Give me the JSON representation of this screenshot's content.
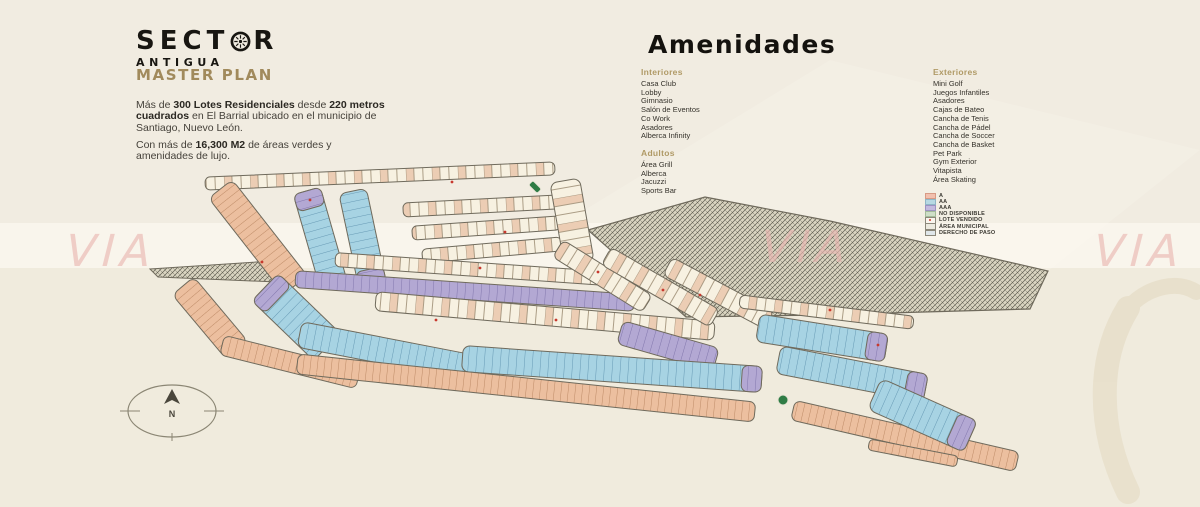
{
  "logo": {
    "word_start": "SECT",
    "word_end": "R",
    "subtitle": "ANTIGUA"
  },
  "intro": {
    "title": "MASTER PLAN",
    "p1_runs": [
      {
        "t": "Más de "
      },
      {
        "t": "300 Lotes Residenciales",
        "b": true
      },
      {
        "t": " desde "
      },
      {
        "t": "220 metros cuadrados",
        "b": true
      },
      {
        "t": " en El Barrial ubicado en el municipio de Santiago, Nuevo León."
      }
    ],
    "p2_runs": [
      {
        "t": "Con más de "
      },
      {
        "t": "16,300 M2",
        "b": true
      },
      {
        "t": " de áreas verdes y amenidades de lujo."
      }
    ]
  },
  "amenities": {
    "title": "Amenidades",
    "groups": [
      {
        "heading": "Interiores",
        "items": [
          "Casa Club",
          "Lobby",
          "Gimnasio",
          "Salón de Eventos",
          "Co Work",
          "Asadores",
          "Alberca Infinity"
        ]
      },
      {
        "heading": "Adultos",
        "items": [
          "Área Grill",
          "Alberca",
          "Jacuzzi",
          "Sports Bar"
        ]
      },
      {
        "heading": "Exteriores",
        "items": [
          "Mini Golf",
          "Juegos Infantiles",
          "Asadores",
          "Cajas de Bateo",
          "Cancha de Tenis",
          "Cancha de Pádel",
          "Cancha de Soccer",
          "Cancha de Basket",
          "Pet Park",
          "Gym Exterior",
          "Vitapista",
          "Área Skating"
        ]
      }
    ]
  },
  "legend": {
    "items": [
      {
        "label": "A",
        "fill": "#f2c0ae",
        "border": "#d79a84"
      },
      {
        "label": "AA",
        "fill": "#b7d9e3",
        "border": "#8fb6c6"
      },
      {
        "label": "AAA",
        "fill": "#c3bade",
        "border": "#9d92c2"
      },
      {
        "label": "NO DISPONIBLE",
        "fill": "#cfdfc8",
        "border": "#a3bb9a"
      },
      {
        "label": "LOTE VENDIDO",
        "fill": "#faf6ee",
        "border": "#8c887a",
        "dot": "#cf3a2e"
      },
      {
        "label": "ÁREA MUNICIPAL",
        "fill": "#eceadf",
        "border": "#8c887a"
      },
      {
        "label": "DERECHO DE PASO",
        "fill": "#e0e7ea",
        "border": "#8c887a"
      }
    ]
  },
  "map": {
    "compass_label": "N",
    "watermark": "VIA"
  },
  "colors": {
    "accent_heading": "#a18a5c",
    "lot_a": "#ecbf9f",
    "lot_aa": "#a7d3e3",
    "lot_aaa": "#b3a8d3",
    "lot_open": "#f7f1e1",
    "municipal_hatch": "#d9d4c0",
    "entrance_green": "#2f7c45",
    "sold_dot": "#c8392e",
    "watermark_pink": "#eab7b2"
  }
}
